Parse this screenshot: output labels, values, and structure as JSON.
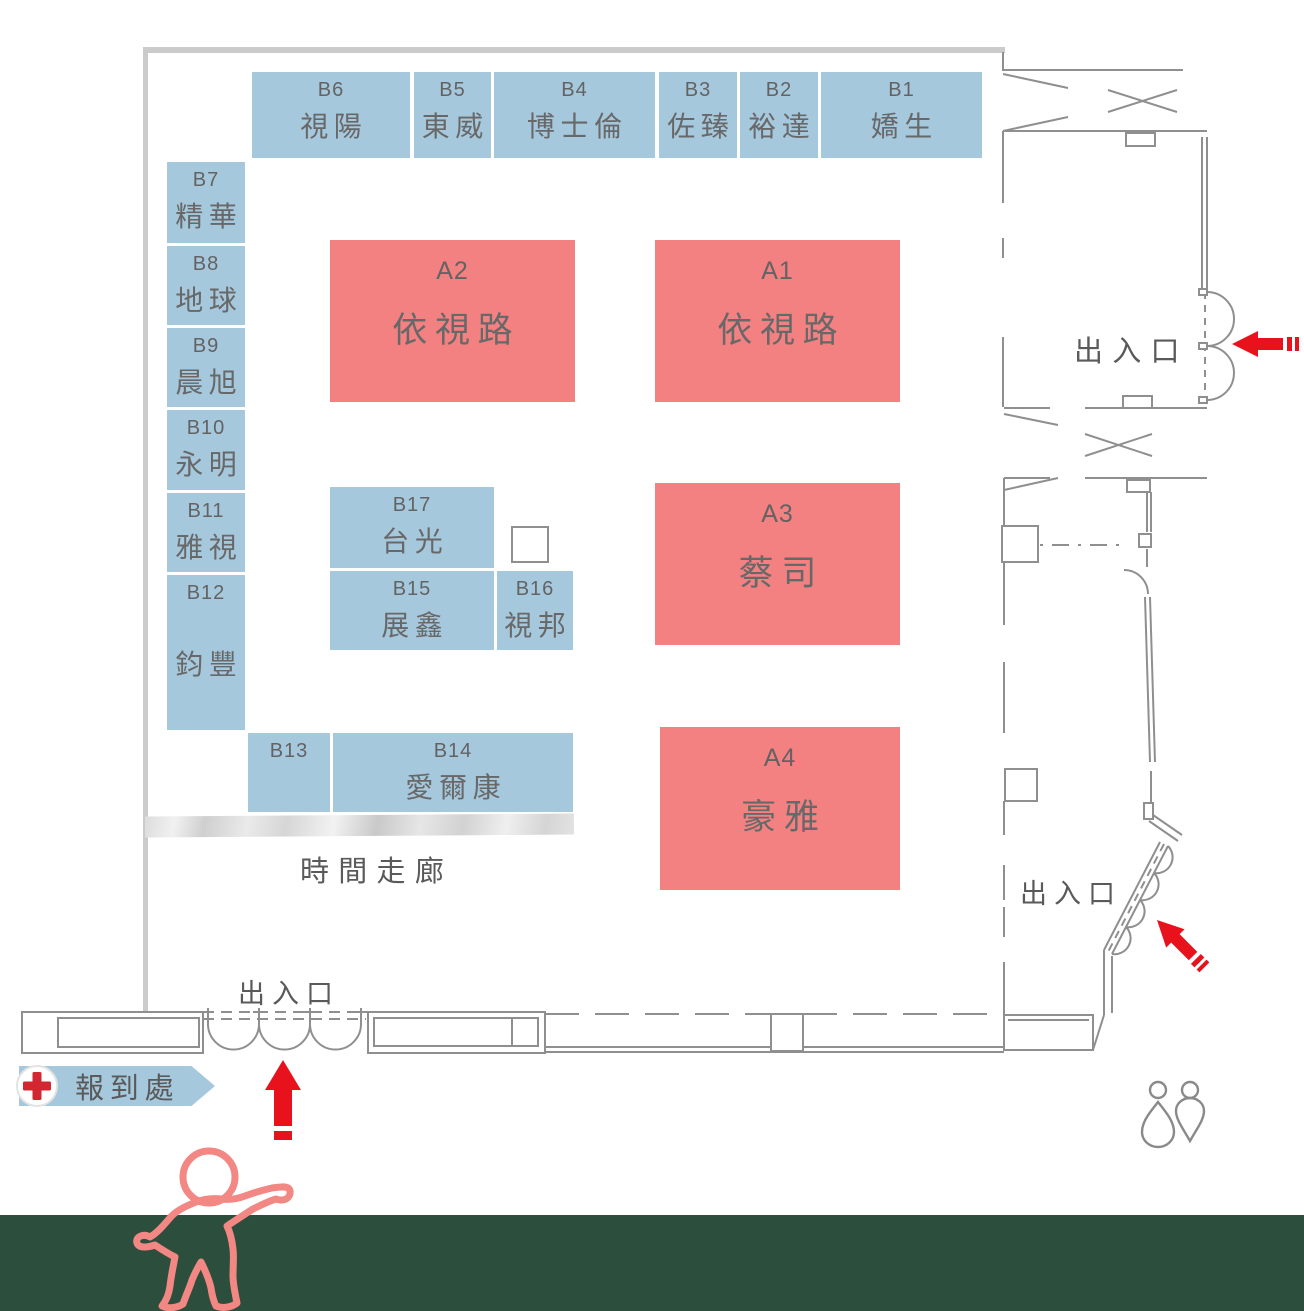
{
  "labels": {
    "entrance": "出入口",
    "registration": "報到處",
    "time_corridor": "時間走廊"
  },
  "booths": {
    "a1": {
      "id": "A1",
      "name": "依視路"
    },
    "a2": {
      "id": "A2",
      "name": "依視路"
    },
    "a3": {
      "id": "A3",
      "name": "蔡司"
    },
    "a4": {
      "id": "A4",
      "name": "豪雅"
    },
    "b1": {
      "id": "B1",
      "name": "嬌生"
    },
    "b2": {
      "id": "B2",
      "name": "裕達"
    },
    "b3": {
      "id": "B3",
      "name": "佐臻"
    },
    "b4": {
      "id": "B4",
      "name": "博士倫"
    },
    "b5": {
      "id": "B5",
      "name": "東威"
    },
    "b6": {
      "id": "B6",
      "name": "視陽"
    },
    "b7": {
      "id": "B7",
      "name": "精華"
    },
    "b8": {
      "id": "B8",
      "name": "地球"
    },
    "b9": {
      "id": "B9",
      "name": "晨旭"
    },
    "b10": {
      "id": "B10",
      "name": "永明"
    },
    "b11": {
      "id": "B11",
      "name": "雅視"
    },
    "b12": {
      "id": "B12",
      "name": "鈞豐"
    },
    "b13": {
      "id": "B13",
      "name": ""
    },
    "b14": {
      "id": "B14",
      "name": "愛爾康"
    },
    "b15": {
      "id": "B15",
      "name": "展鑫"
    },
    "b16": {
      "id": "B16",
      "name": "視邦"
    },
    "b17": {
      "id": "B17",
      "name": "台光"
    }
  },
  "icons": {
    "registration_cross": "first-aid-cross",
    "restroom": "restroom-figures",
    "direction_arrows": "red-direction-arrow",
    "visitor": "person-outline"
  },
  "colors": {
    "booth_blue": "#a6c8dd",
    "booth_red": "#f48181",
    "wall_gray": "#cbcbcb",
    "line_gray": "#8f8f8f",
    "text_gray": "#5a5a5a",
    "arrow_red": "#e8121d",
    "cross_red": "#d22630",
    "person_pink": "#f28783",
    "footer_green": "#2c4e3c"
  }
}
